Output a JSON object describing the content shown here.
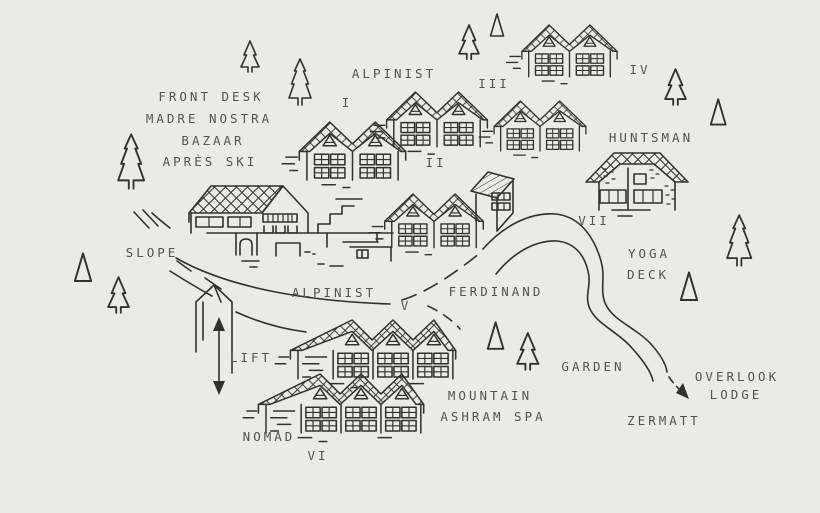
{
  "map": {
    "colors": {
      "background": "#EDEAE5",
      "ink": "#33312E",
      "label": "#55534E"
    },
    "labels": {
      "front_desk": "FRONT DESK",
      "madre_nostra": "MADRE NOSTRA",
      "bazaar": "BAZAAR",
      "apres_ski": "APRÈS SKI",
      "alpinist_upper": "ALPINIST",
      "huntsman": "HUNTSMAN",
      "slope": "SLOPE",
      "yoga": "YOGA",
      "deck": "DECK",
      "alpinist_path": "ALPINIST",
      "ferdinand": "FERDINAND",
      "lift": "LIFT",
      "garden": "GARDEN",
      "overlook": "OVERLOOK",
      "lodge": "LODGE",
      "mountain": "MOUNTAIN",
      "ashram_spa": "ASHRAM SPA",
      "zermatt": "ZERMATT",
      "nomad": "NOMAD"
    },
    "numerals": {
      "i": "I",
      "ii": "II",
      "iii": "III",
      "iv": "IV",
      "v": "V",
      "vi": "VI",
      "vii": "VII"
    }
  }
}
